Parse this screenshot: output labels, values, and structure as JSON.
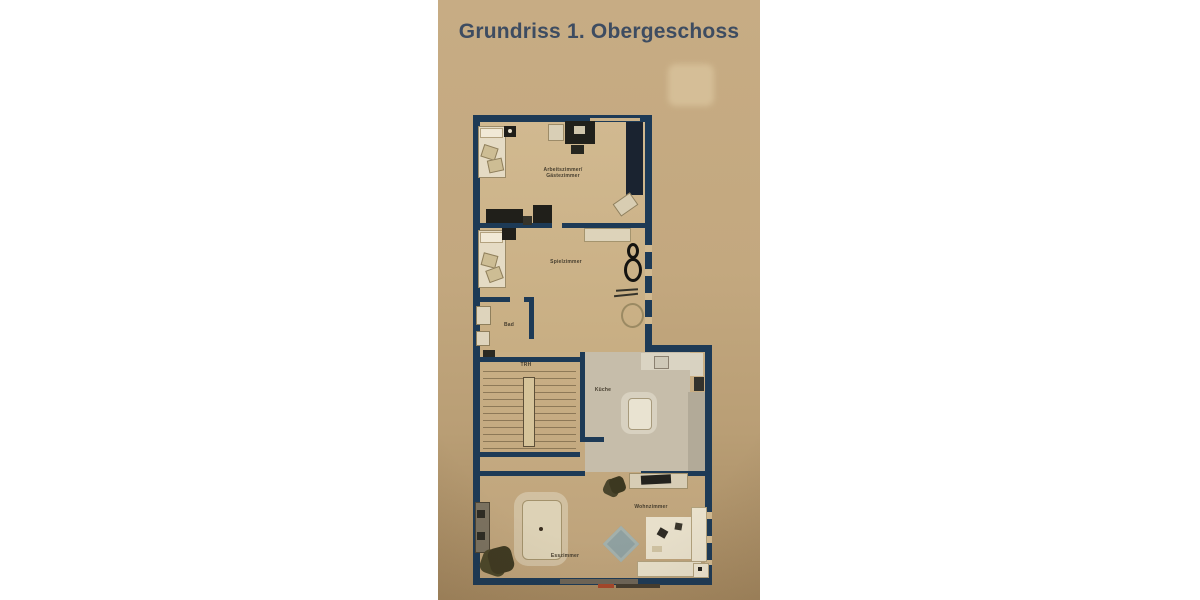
{
  "title": {
    "text": "Grundriss 1. Obergeschoss"
  },
  "floorplan": {
    "labels": {
      "arbeitszimmer_line1": "Arbeitszimmer/",
      "arbeitszimmer_line2": "Gästezimmer",
      "spielzimmer": "Spielzimmer",
      "bad": "Bad",
      "treppenhaus": "TRH",
      "kueche": "Küche",
      "esszimmer": "Esszimmer",
      "wohnzimmer": "Wohnzimmer"
    },
    "rooms": [
      "Arbeitszimmer/Gästezimmer",
      "Spielzimmer",
      "Bad",
      "TRH",
      "Küche",
      "Esszimmer",
      "Wohnzimmer"
    ]
  },
  "colors": {
    "page_background": "#ffffff",
    "paper": "#c3a87f",
    "wall": "#1d3a56",
    "floor": "#ccb389",
    "kitchen_floor": "#c6bdaa",
    "title_text": "#3d4c61",
    "label_text": "#453d2e",
    "watermark_accent": "#a5472b",
    "watermark_text": "#453d2f"
  }
}
